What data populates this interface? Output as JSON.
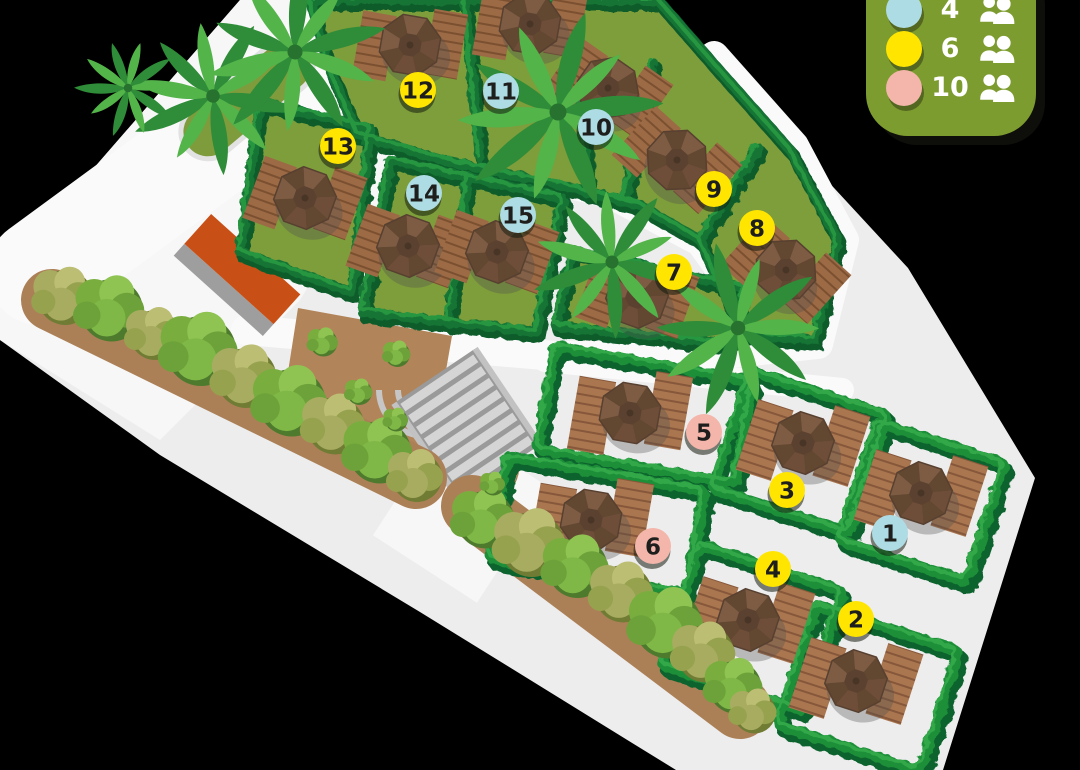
{
  "page": {
    "background_color": "#000000"
  },
  "legend": {
    "background_color": "#7D9C2F",
    "items": [
      {
        "capacity": "4",
        "color": "#AEDCE4"
      },
      {
        "capacity": "6",
        "color": "#FFE500"
      },
      {
        "capacity": "10",
        "color": "#F4B6AA"
      }
    ]
  },
  "map": {
    "ground_color": "#EDEDED",
    "walkway_color": "#FAFAFA",
    "lawn_color": "#7E9D3A",
    "hedge_color": "#1E8F38",
    "dirt_color": "#AC8057",
    "building_color": "#C85017",
    "spots": [
      {
        "number": "1",
        "capacity": "4",
        "color": "#AEDCE4",
        "x": 890,
        "y": 533
      },
      {
        "number": "2",
        "capacity": "6",
        "color": "#FFE500",
        "x": 856,
        "y": 619
      },
      {
        "number": "3",
        "capacity": "6",
        "color": "#FFE500",
        "x": 787,
        "y": 490
      },
      {
        "number": "4",
        "capacity": "6",
        "color": "#FFE500",
        "x": 773,
        "y": 569
      },
      {
        "number": "5",
        "capacity": "10",
        "color": "#F4B6AA",
        "x": 704,
        "y": 432
      },
      {
        "number": "6",
        "capacity": "10",
        "color": "#F4B6AA",
        "x": 653,
        "y": 546
      },
      {
        "number": "7",
        "capacity": "6",
        "color": "#FFE500",
        "x": 674,
        "y": 272
      },
      {
        "number": "8",
        "capacity": "6",
        "color": "#FFE500",
        "x": 757,
        "y": 228
      },
      {
        "number": "9",
        "capacity": "6",
        "color": "#FFE500",
        "x": 714,
        "y": 189
      },
      {
        "number": "10",
        "capacity": "4",
        "color": "#AEDCE4",
        "x": 596,
        "y": 127
      },
      {
        "number": "11",
        "capacity": "4",
        "color": "#AEDCE4",
        "x": 501,
        "y": 91
      },
      {
        "number": "12",
        "capacity": "6",
        "color": "#FFE500",
        "x": 418,
        "y": 90
      },
      {
        "number": "13",
        "capacity": "6",
        "color": "#FFE500",
        "x": 338,
        "y": 146
      },
      {
        "number": "14",
        "capacity": "4",
        "color": "#AEDCE4",
        "x": 424,
        "y": 193
      },
      {
        "number": "15",
        "capacity": "4",
        "color": "#AEDCE4",
        "x": 518,
        "y": 215
      }
    ]
  }
}
